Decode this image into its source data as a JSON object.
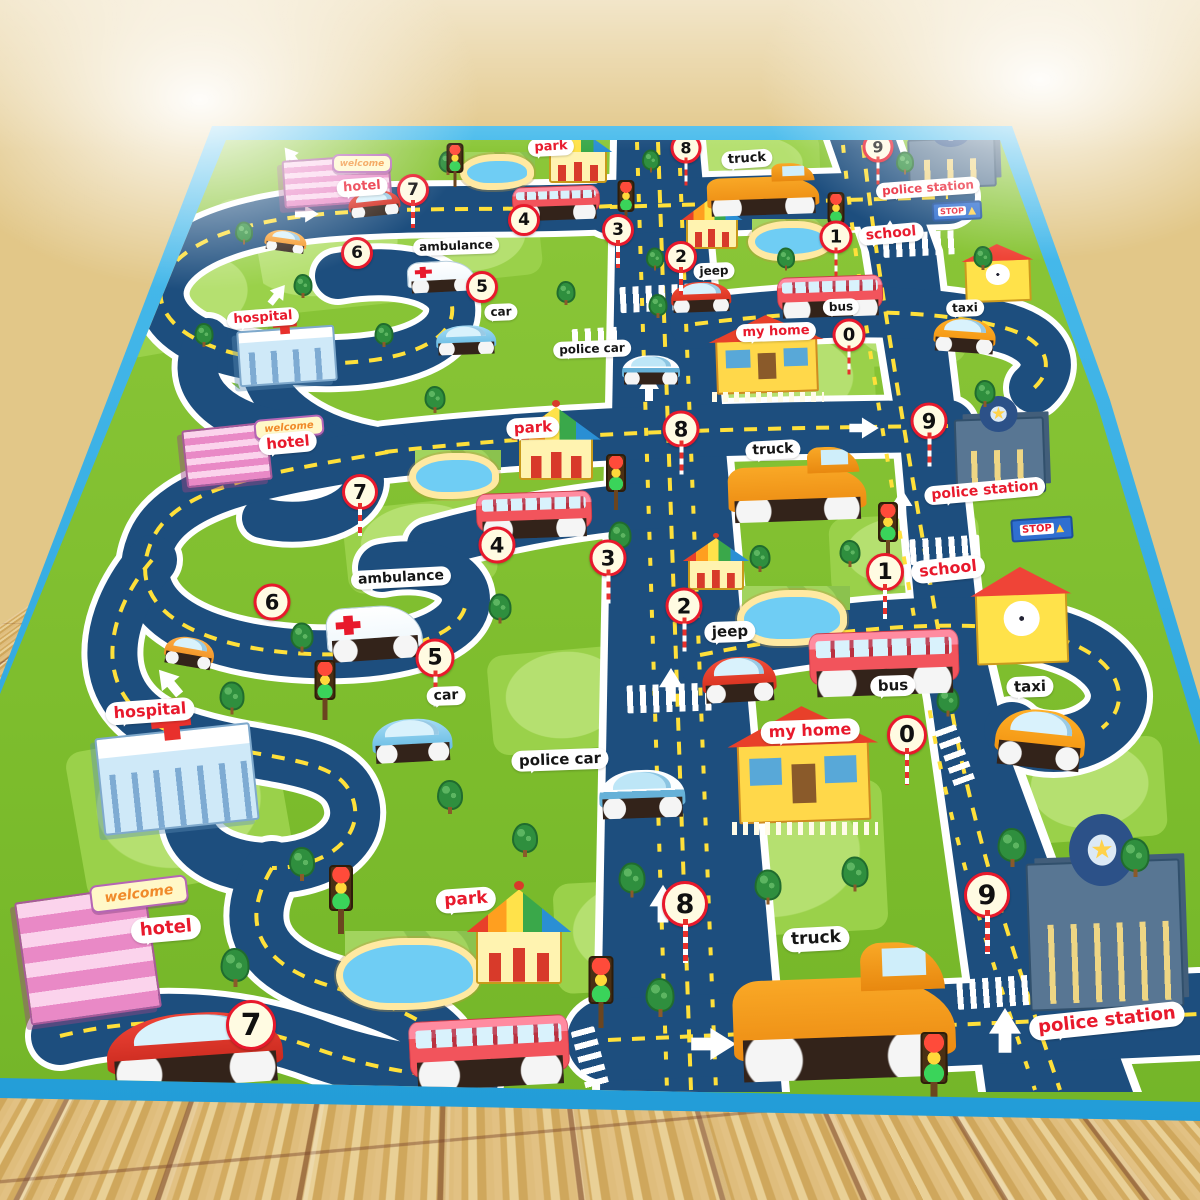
{
  "scene": {
    "subject": "kids educational city road play mat on a wooden floor"
  },
  "palette": {
    "mat_border": "#2aa9e0",
    "grass": "#7dbd2d",
    "road": "#1d4e7e",
    "road_dash": "#ffe03a",
    "label_red": "#e8192c",
    "label_black": "#151515"
  },
  "labels": {
    "hotel": "hotel",
    "park": "park",
    "truck": "truck",
    "police_station": "police station",
    "school": "school",
    "ambulance": "ambulance",
    "jeep": "jeep",
    "bus": "bus",
    "taxi": "taxi",
    "my_home": "my home",
    "car": "car",
    "hospital": "hospital",
    "police_car": "police car",
    "welcome": "welcome",
    "stop": "STOP"
  },
  "numbers": {
    "n0": "0",
    "n1": "1",
    "n2": "2",
    "n3": "3",
    "n4": "4",
    "n5": "5",
    "n6": "6",
    "n7": "7",
    "n8": "8",
    "n9": "9"
  }
}
